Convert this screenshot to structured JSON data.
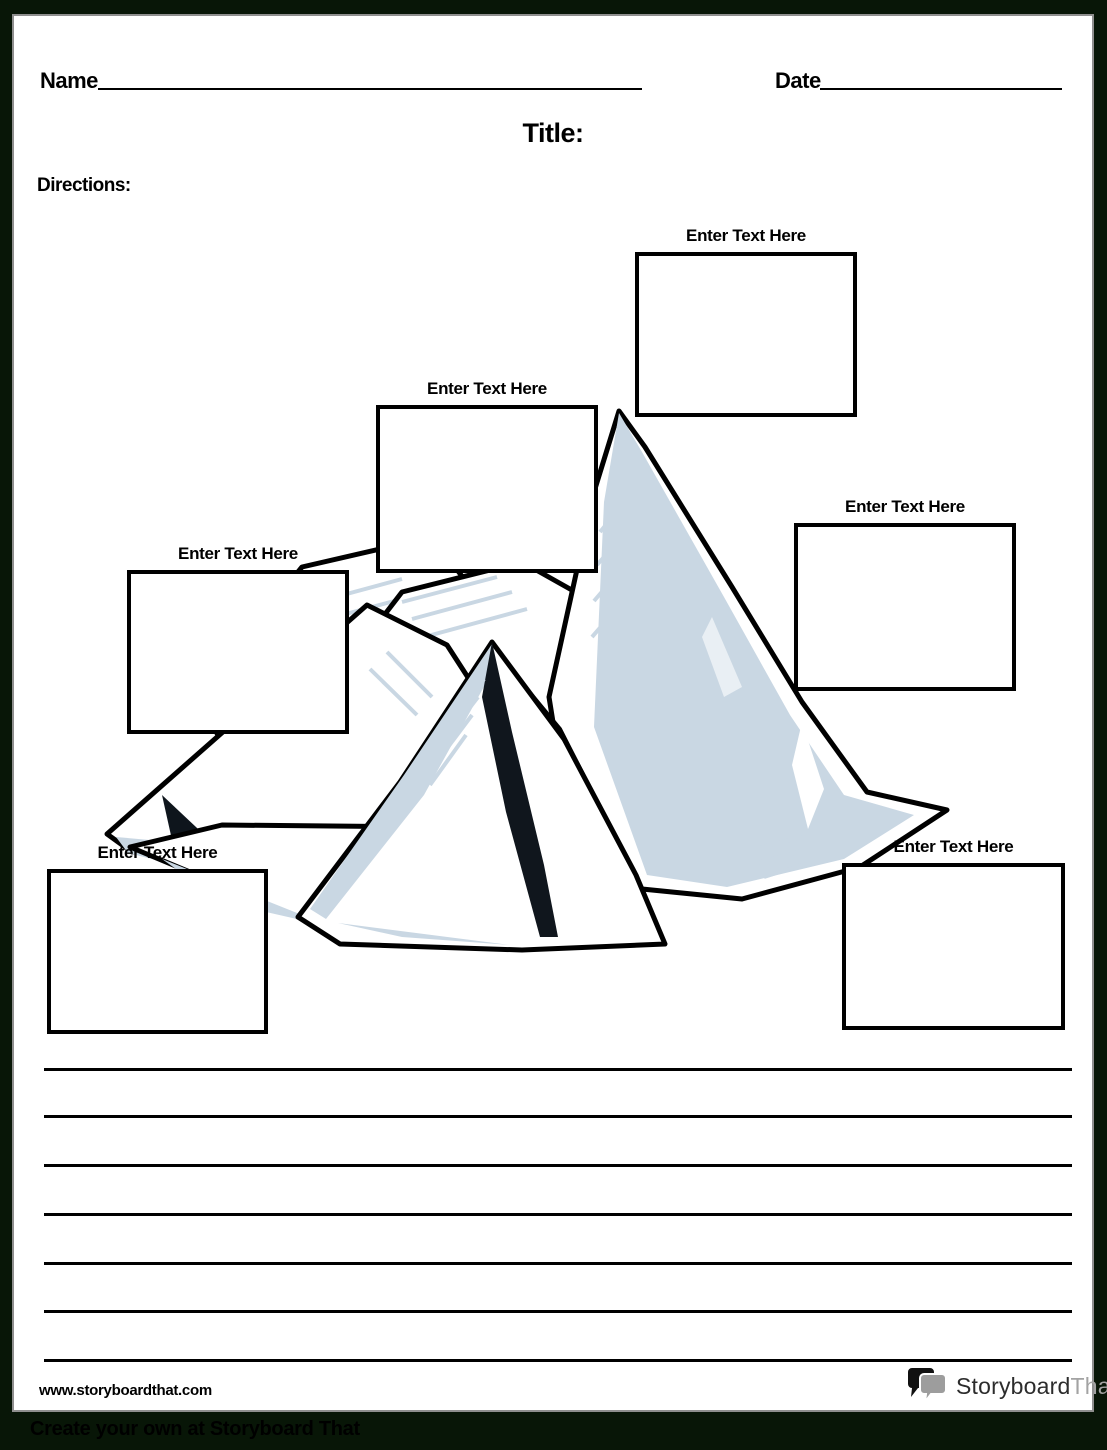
{
  "page": {
    "name_label": "Name",
    "date_label": "Date",
    "title_label": "Title:",
    "directions_label": "Directions:",
    "footer_url": "www.storyboardthat.com",
    "footer_banner": "Create your own at Storyboard That"
  },
  "text_boxes": [
    {
      "id": "top-center",
      "label": "Enter Text Here"
    },
    {
      "id": "upper-middle",
      "label": "Enter Text Here"
    },
    {
      "id": "middle-left",
      "label": "Enter Text Here"
    },
    {
      "id": "right",
      "label": "Enter Text Here"
    },
    {
      "id": "bottom-left",
      "label": "Enter Text Here"
    },
    {
      "id": "bottom-right",
      "label": "Enter Text Here"
    }
  ],
  "writing_lines_count": 7,
  "logo": {
    "part1": "Storyboard",
    "part2": "That",
    "icon": "speech-bubbles-icon"
  },
  "illustration": "iceberg-mountain",
  "colors": {
    "frame": "#081607",
    "paper": "#ffffff",
    "ink": "#000000",
    "iceberg_shade": "#c9d7e3",
    "logo_gray": "#a3a3a3"
  }
}
